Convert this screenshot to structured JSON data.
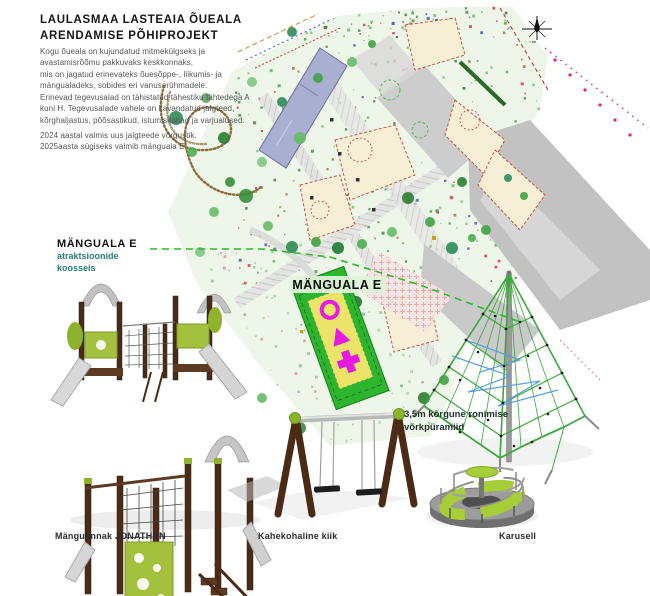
{
  "header": {
    "title": [
      "LAULASMAA LASTEAIA ÕUEALA",
      "ARENDAMISE PÕHIPROJEKT"
    ],
    "paragraph1": [
      "Kogu õueala on kujundatud mitmekülgseks ja",
      "avastamisrõõmu pakkuvaks keskkonnaks,",
      "mis on jagatud erinevateks õuesõppe-, liikumis- ja",
      "mängualadeks, sobides eri vanuserühmadele."
    ],
    "paragraph2": [
      "Erinevad tegevusalad on tähistatud tähestiku tähtedega A",
      "kuni H. Tegevusalade vahele on kavandatud jalgteed,",
      "kõrghaljastus, põõsastikud, istumiskohad ja varjualused."
    ],
    "paragraph3": [
      "2024 aastal valmis uus jalgteede võrgustik.",
      "2025aasta sügiseks valmib mänguala E."
    ]
  },
  "callouts": {
    "area_heading": "MÄNGUALA E",
    "area_subtitle1": "atraktsioonide",
    "area_subtitle2": "koosseis",
    "map_area_label": "MÄNGUALA E",
    "net_pyramid_line1": "3,5m kõrgune ronimise",
    "net_pyramid_line2": "võrkpüramiid"
  },
  "equipment_labels": {
    "playhouse": "Mängulinnak JONATHAN",
    "swing": "Kahekohaline kiik",
    "carousel": "Karusell"
  },
  "colors": {
    "play_area_green": "#2db52d",
    "play_area_yellow": "#ece468",
    "icon_magenta": "#e619e6",
    "equipment_lime": "#a6ce39",
    "wood_brown": "#4b2b16",
    "accent_teal": "#2a7b7b",
    "net_green": "#3aa83a",
    "net_blue": "#5aa0e0",
    "building_violet": "#a9afd1"
  }
}
